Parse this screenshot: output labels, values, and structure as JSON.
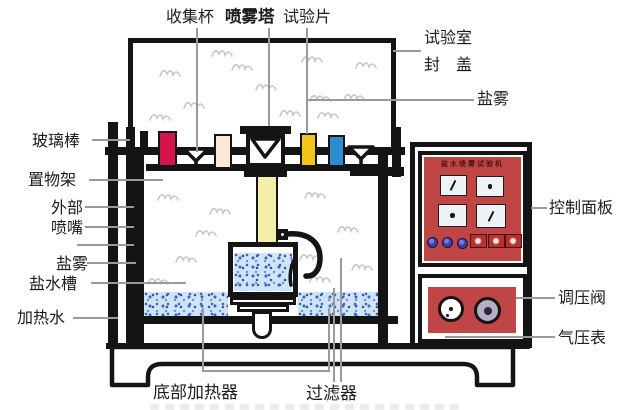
{
  "labels": {
    "collector_cup": "收集杯",
    "spray_tower": "喷雾塔",
    "test_piece": "试验片",
    "test_chamber": "试验室",
    "chamber_lid": "封　盖",
    "salt_fog_right": "盐雾",
    "glass_rod": "玻璃棒",
    "shelf_rack": "置物架",
    "external": "外部",
    "nozzle": "喷嘴",
    "salt_fog_left": "盐雾",
    "salt_water_tank": "盐水槽",
    "heated_water": "加热水",
    "control_panel": "控制面板",
    "pressure_regulator": "调压阀",
    "air_pressure_gauge": "气压表",
    "bottom_heater": "底部加热器",
    "filter": "过滤器"
  },
  "panel": {
    "title": "盐水喷雾试验机"
  },
  "colors": {
    "line": "#141414",
    "leader": "#9a9a9a",
    "sample-red": "#d5134d",
    "sample-cream": "#f9e7da",
    "sample-yellow": "#f2c51d",
    "sample-blue": "#2d8ccb",
    "tower-yellow": "#f4efa8",
    "panel-red": "#c04545",
    "water-base": "#cfe4f7",
    "water-speck": "#3a64bd",
    "knob-gray": "#b7aec5",
    "btn-blue": "#3a3fa0",
    "btn-red": "#b53232",
    "fog": "#c6c6c6"
  }
}
